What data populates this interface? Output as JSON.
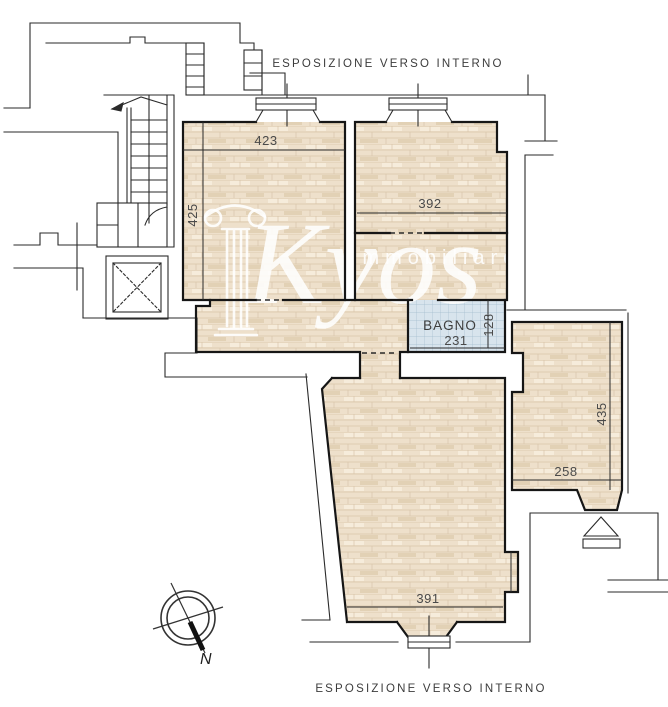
{
  "plan": {
    "exposure_top": "ESPOSIZIONE VERSO INTERNO",
    "exposure_bottom": "ESPOSIZIONE VERSO INTERNO",
    "compass": {
      "north_label": "N"
    },
    "watermark": {
      "brand": "Kyos",
      "subtitle": "immobiliare"
    },
    "rooms": [
      {
        "name": "camera-1",
        "dim_width": "423",
        "dim_height": "425"
      },
      {
        "name": "camera-2",
        "dim_width": "392"
      },
      {
        "name": "bagno",
        "label": "BAGNO",
        "dim_width": "231",
        "dim_height": "128"
      },
      {
        "name": "camera-3",
        "dim_width": "258",
        "dim_height": "435"
      },
      {
        "name": "soggiorno",
        "dim_width": "391"
      }
    ],
    "colors": {
      "wood": "#eee0cb",
      "wood_line": "#d9c5aa",
      "tile": "#d8e4ed",
      "tile_line": "#a3bccd",
      "wall": "#161616",
      "label": "#4a4a4a"
    }
  }
}
